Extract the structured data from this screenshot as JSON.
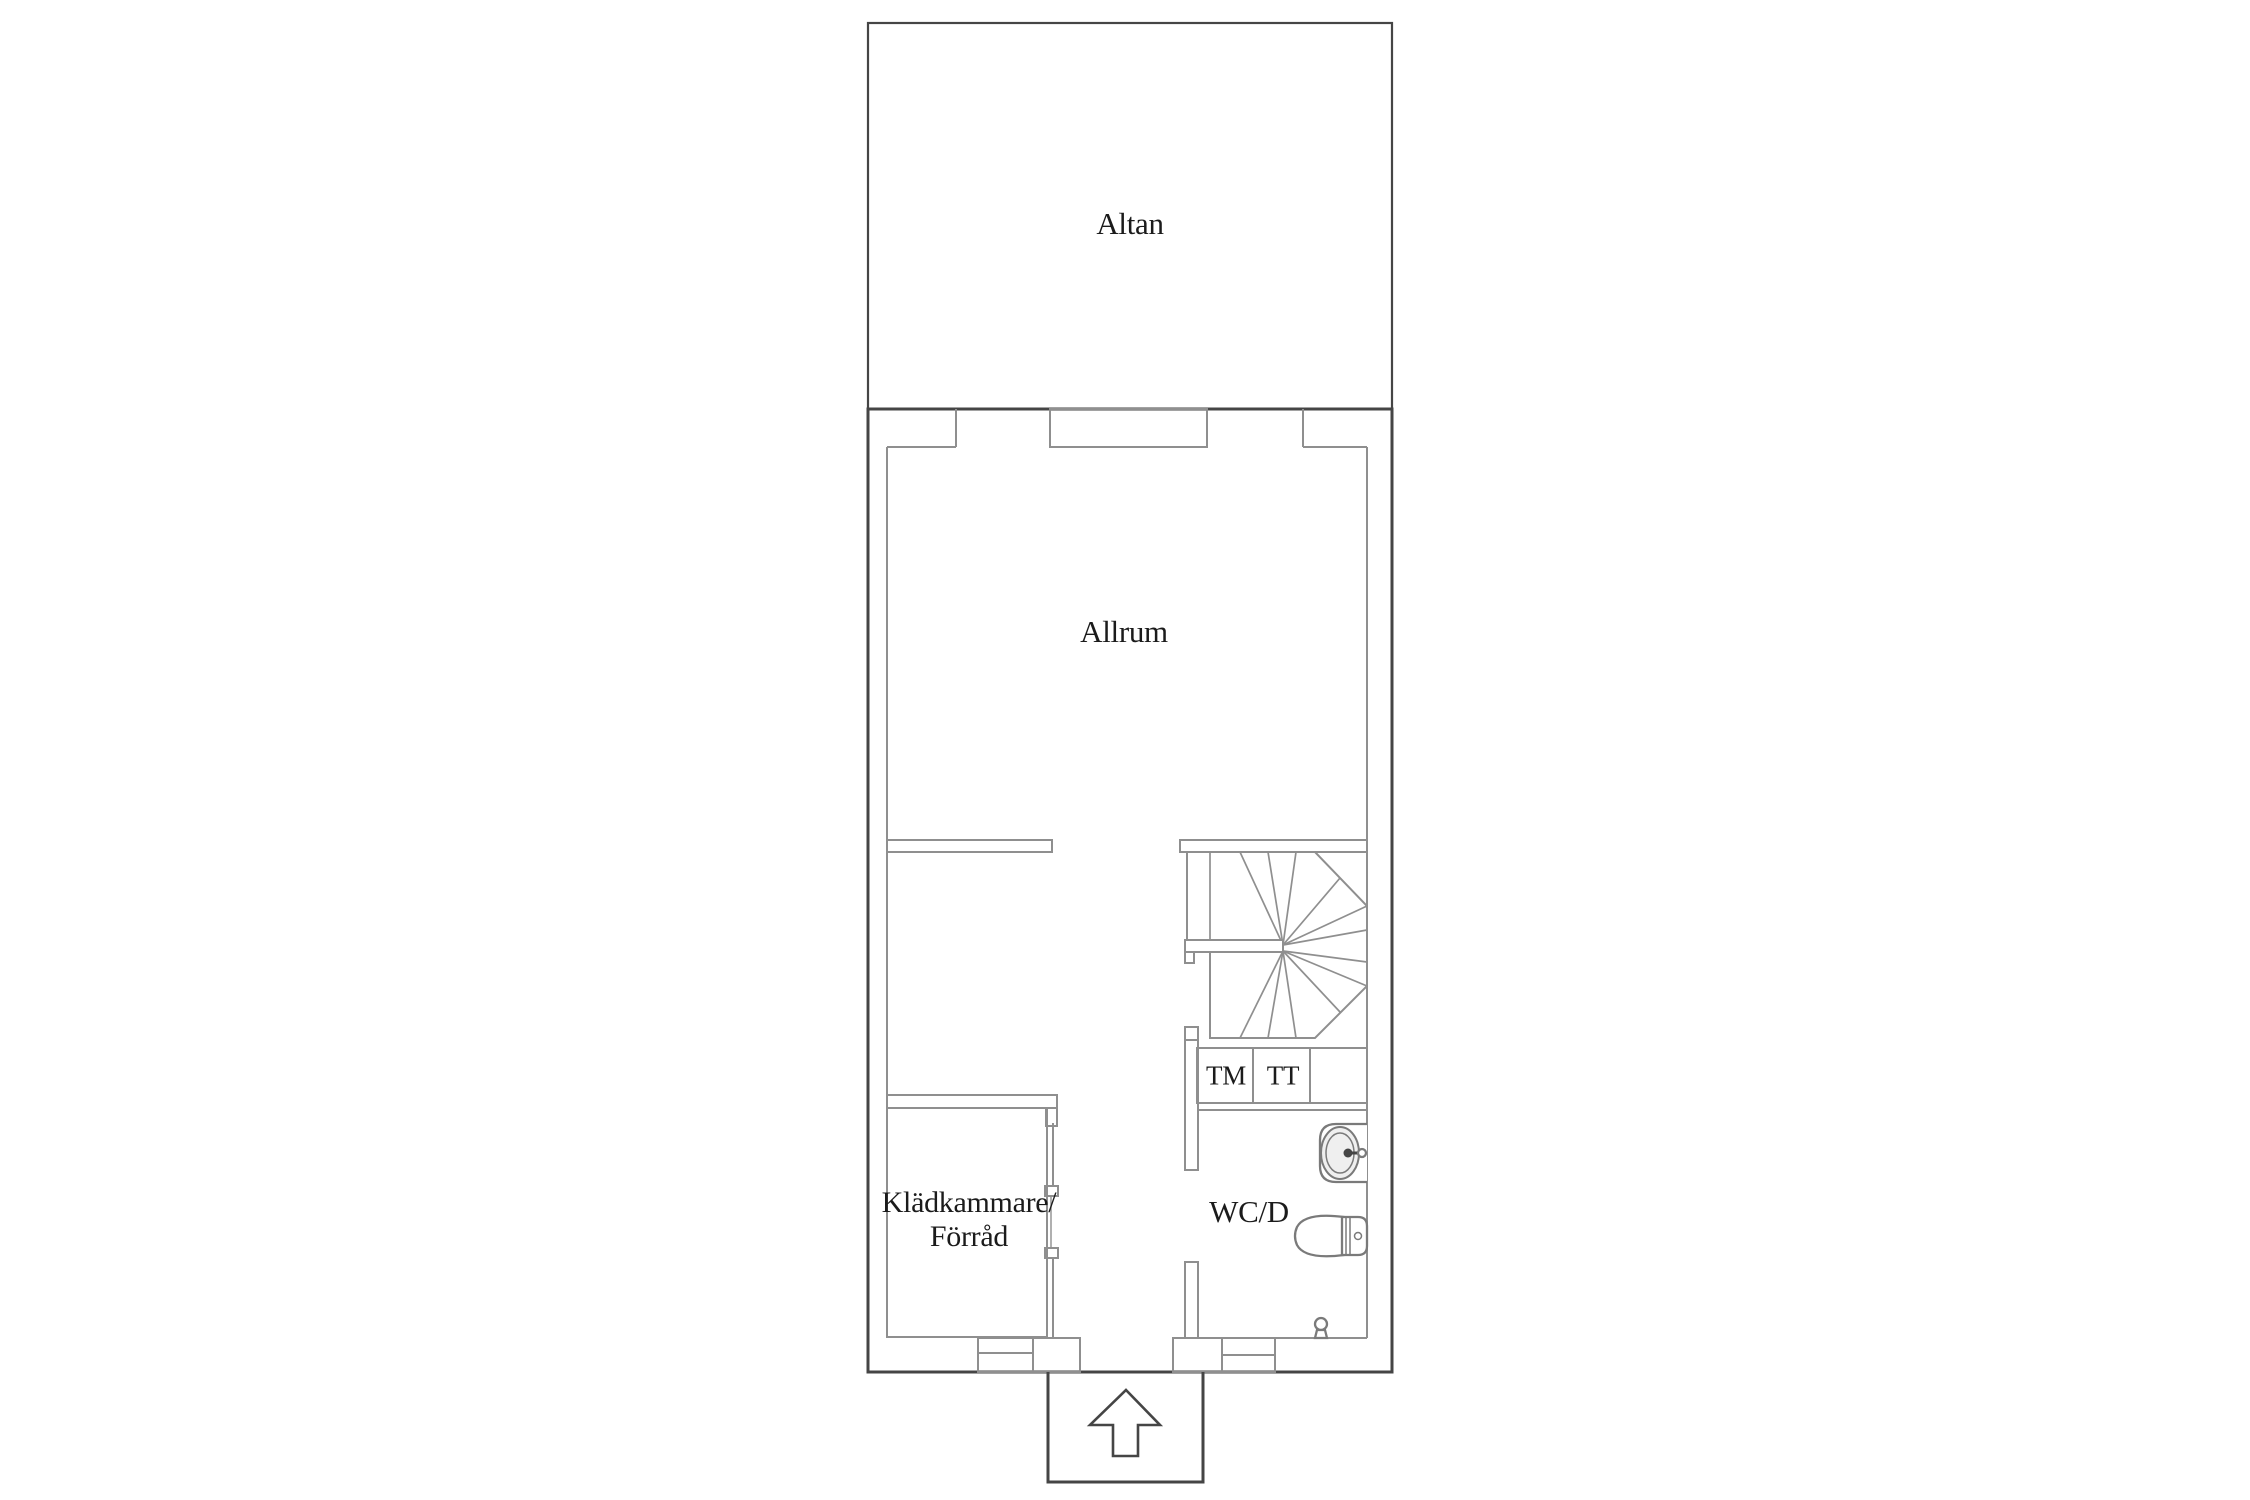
{
  "page": {
    "kind": "floor-plan",
    "background": "#ffffff"
  },
  "rooms": {
    "altan": "Altan",
    "allrum": "Allrum",
    "kladkammare_line1": "Klädkammare/",
    "kladkammare_line2": "Förråd",
    "wc": "WC/D"
  },
  "appliances": {
    "washing_machine": "TM",
    "tumble_dryer": "TT"
  },
  "symbols": {
    "staircase": "winder-staircase",
    "sink": "sink-icon",
    "toilet": "toilet-icon",
    "entrance_arrow": "entrance-arrow-icon",
    "door_stop": "door-stop-icon"
  },
  "colors": {
    "background": "#ffffff",
    "outer_wall": "#454545",
    "inner_wall": "#8f8f8f",
    "fixture": "#7a7a7a",
    "text": "#1b1b1b"
  }
}
